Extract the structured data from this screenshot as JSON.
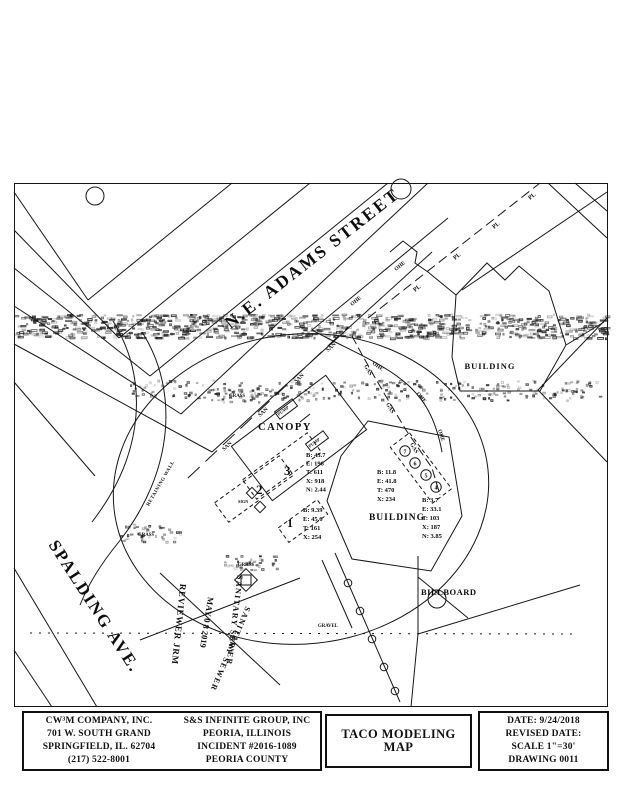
{
  "map": {
    "streets": {
      "adams": "N.E. ADAMS STREET",
      "spalding": "SPALDING AVE."
    },
    "areas": {
      "canopy": "CANOPY",
      "building_main": "BUILDING",
      "building_ne": "BUILDING",
      "billboard": "BILLBOARD",
      "retaining_wall": "RETAINING WALL",
      "grass": "GRASS",
      "gravel": "GRAVEL",
      "sign": "SIGN",
      "pump": "PUMP"
    },
    "tanks": [
      "1",
      "2",
      "3"
    ],
    "points": [
      "4",
      "5",
      "6",
      "7"
    ],
    "utilities": {
      "san": "SAN",
      "ohe": "OHE",
      "gas": "GAS",
      "pl": "PL"
    },
    "data_blocks": [
      {
        "id": "canopy-east",
        "lines": [
          "B: 43.7",
          "E: 196",
          "T: 611",
          "X: 918",
          "N: 2.44"
        ]
      },
      {
        "id": "tank-1",
        "lines": [
          "B: 9.39",
          "E: 45.6",
          "T: 161",
          "X: 254"
        ]
      },
      {
        "id": "building-west",
        "lines": [
          "B: 11.8",
          "E: 41.8",
          "T: 470",
          "X: 234"
        ]
      },
      {
        "id": "building-south",
        "lines": [
          "B: 3.7",
          "E: 33.1",
          "T: 103",
          "X: 187",
          "N: 3.85"
        ]
      }
    ],
    "stamps": {
      "reviewer": "REVIEWER JRM",
      "received_date": "MAY 0 8 2019",
      "sewer_label_1": "SANITARY SEWER",
      "sewer_label_2": "SANITARY SEWER"
    }
  },
  "title_block": {
    "company": {
      "lines": [
        "CW³M COMPANY, INC.",
        "701 W. SOUTH GRAND",
        "SPRINGFIELD, IL. 62704",
        "(217) 522-8001"
      ]
    },
    "client": {
      "lines": [
        "S&S INFINITE GROUP, INC",
        "PEORIA, ILLINOIS",
        "INCIDENT #2016-1089",
        "PEORIA COUNTY"
      ]
    },
    "map_title": "TACO MODELING MAP",
    "drawing_info": {
      "lines": [
        "DATE: 9/24/2018",
        "REVISED DATE:",
        "SCALE 1\"=30'",
        "DRAWING 0011"
      ]
    }
  },
  "colors": {
    "ink": "#111111",
    "paper": "#ffffff"
  }
}
